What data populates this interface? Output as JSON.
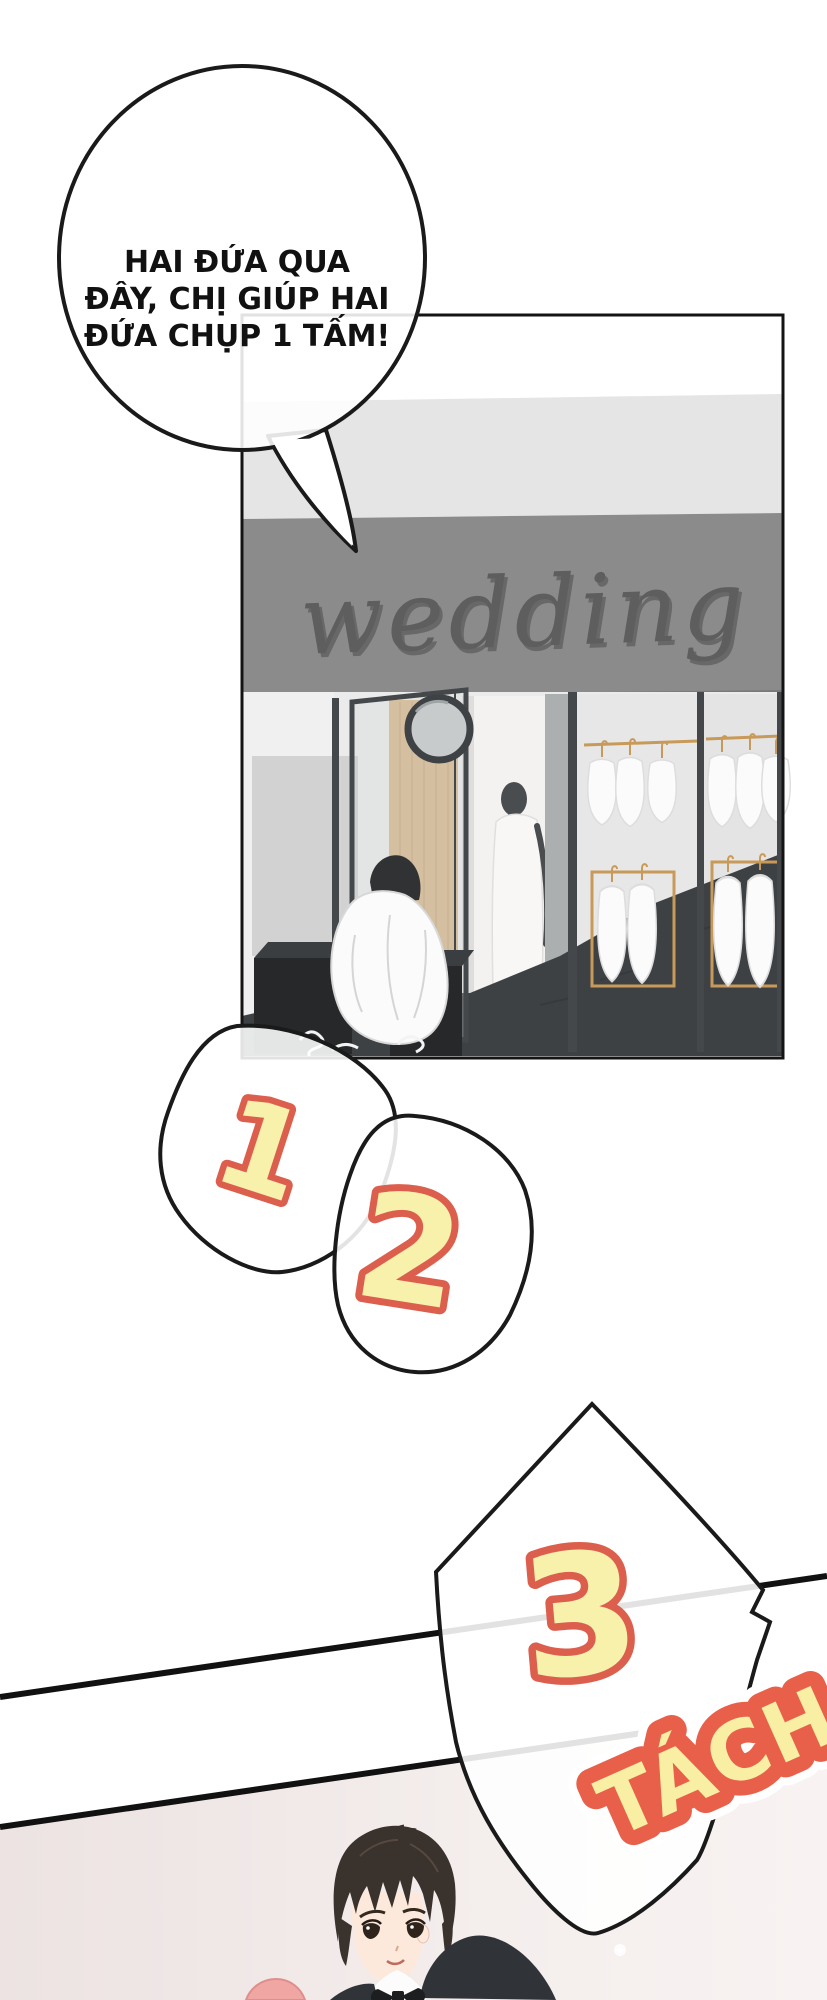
{
  "page": {
    "kind": "comic-page"
  },
  "speech_bubble": {
    "lines": [
      "HAI ĐỨA QUA",
      "ĐÂY, CHỊ GIÚP HAI",
      "ĐỨA CHỤP 1 TẤM!"
    ]
  },
  "shop_panel": {
    "sign_text": "wedding"
  },
  "countdown": {
    "step1": "1",
    "step2": "2",
    "step3": "3"
  },
  "sfx": {
    "shutter": "TÁCH"
  },
  "colors": {
    "number_fill": "#F8F1AC",
    "number_outline": "#DC5F4E",
    "sfx_fill": "#F8EFA4",
    "sfx_outline": "#E8604A",
    "sign_wall": "#8B8B8B",
    "sign_text": "#5E5E5E",
    "ceiling": "#E5E5E5",
    "floor": "#3E4144",
    "wood_door": "#D8B88E",
    "gold_rack": "#C89A5A",
    "bottom_panel_bg": "#F0E9E8",
    "panel_border": "#141414"
  }
}
